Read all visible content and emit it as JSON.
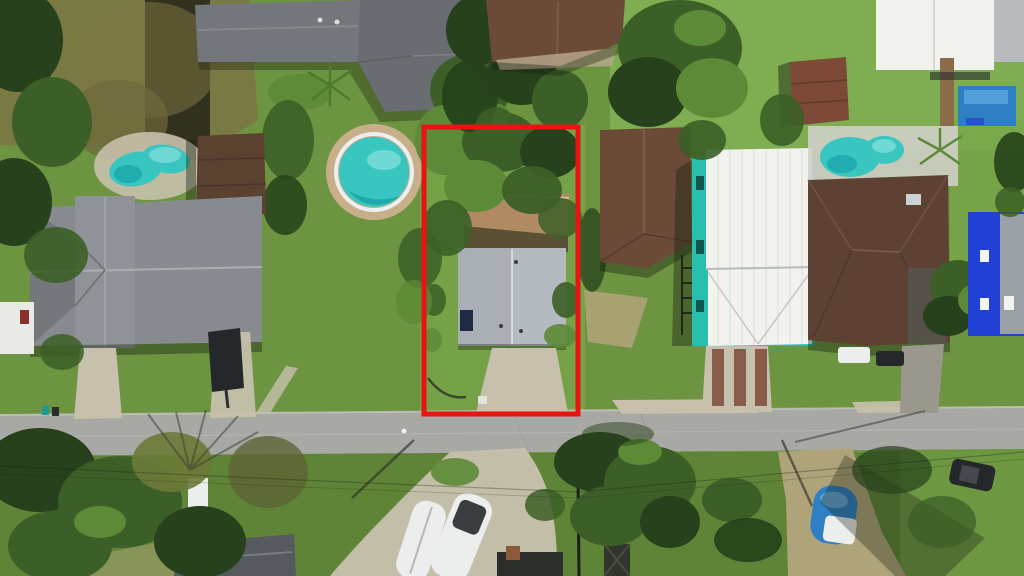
{
  "scene": {
    "type": "aerial-photo",
    "description": "Top-down drone photograph of a suburban residential block; a red rectangle outlines the subject property: a small gray-roofed house with rear deck, tree-covered yard and driveway fronting the street.",
    "street_orientation": "horizontal, lower third of frame",
    "outline": {
      "shape": "rectangle",
      "x": 424,
      "y": 127,
      "width": 154,
      "height": 287,
      "stroke_width": 5,
      "color": "#e81414"
    },
    "inventory": {
      "houses": 10,
      "swimming_pools": 4,
      "boats": 4,
      "vehicles": 3
    }
  },
  "colors": {
    "grass": "#6d9440",
    "grass_light": "#7fae52",
    "grass_bright": "#79a84a",
    "grass_dark": "#54772f",
    "scrub": "#7b7544",
    "road": "#a8a8a4",
    "concrete": "#c6c0ac",
    "dirt": "#b3a47c",
    "tree": "#3c5f27",
    "tree_light": "#5c8a36",
    "tree_dark": "#26411b",
    "roof_gray_dark": "#73777b",
    "roof_gray": "#878b8f",
    "roof_shingle": "#b4bac0",
    "roof_brown": "#6b4a37",
    "roof_brown_dark": "#5d4233",
    "roof_white": "#f2f3ef",
    "teal": "#28bfae",
    "pool": "#39c6c1",
    "pool_deep": "#17a3a6",
    "pool_blue": "#2e7fc4",
    "blue_house": "#2140d6",
    "deck": "#b08a63",
    "shed_brown": "#5a4130",
    "shed_red": "#7c4a36",
    "boat_white": "#eceded",
    "vehicle_dark": "#24282b",
    "outline_red": "#e81414",
    "shadow": "#16200e"
  }
}
